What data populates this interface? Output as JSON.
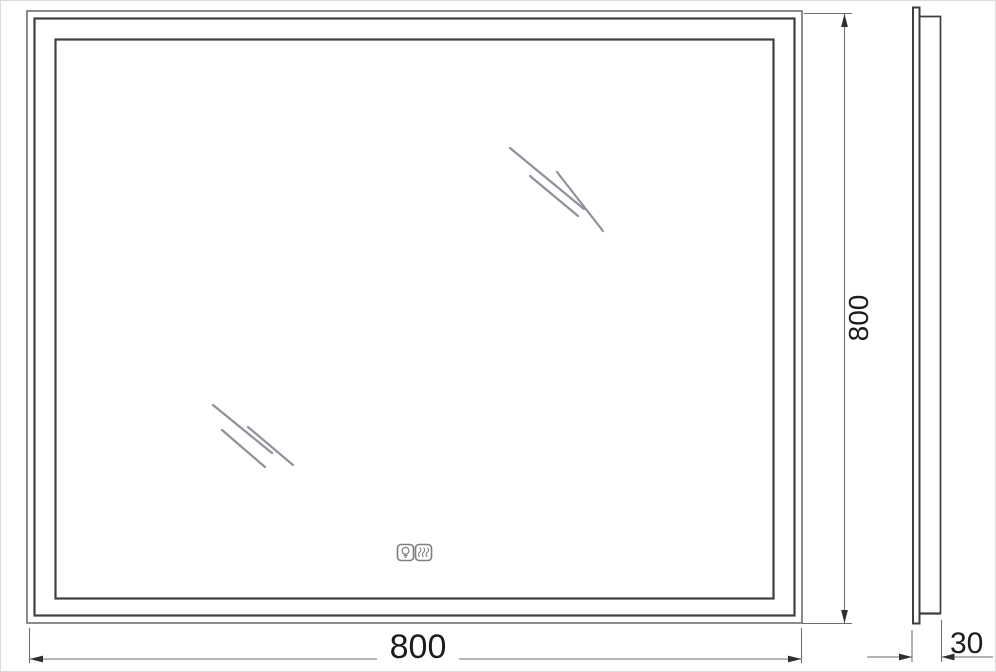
{
  "drawing": {
    "type": "mirror-technical-drawing",
    "views": {
      "front": "front-view",
      "side": "side-view"
    },
    "dimensions": {
      "width_label": "800",
      "height_label": "800",
      "depth_label": "30"
    },
    "icons": {
      "light": "light-bulb-icon",
      "antifog": "anti-fog-heater-icon"
    },
    "colors": {
      "frame_line": "#3f3f3f",
      "outer_line": "#5a5a5a",
      "dimension_line": "#6e6e6e",
      "arrow": "#2e2e2e",
      "shine": "#90909a",
      "icon": "#7f7f7f",
      "text": "#1c1c1c",
      "background": "#ffffff"
    }
  }
}
